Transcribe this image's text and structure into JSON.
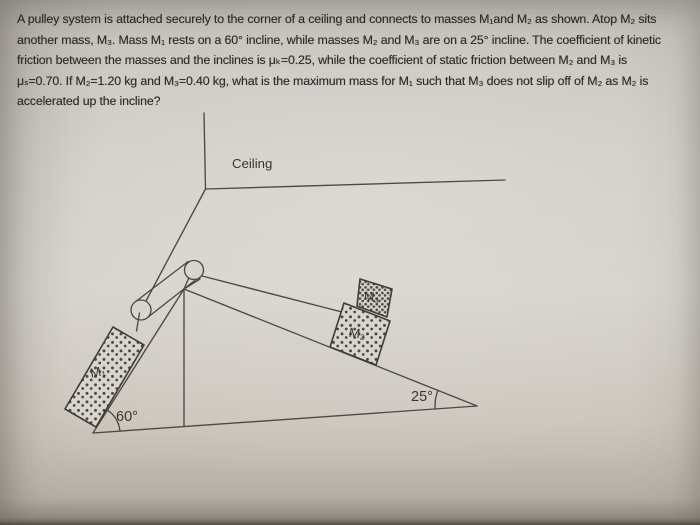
{
  "problem": {
    "lines": [
      "A pulley system is attached securely to the corner of a ceiling and connects to masses M₁and M₂ as shown. Atop M₂ sits",
      "another mass, M₃. Mass M₁ rests on a 60° incline, while masses M₂ and M₃ are on a 25° incline. The coefficient of kinetic",
      "friction between the masses and the inclines is μₖ=0.25, while the coefficient of static friction between M₂ and M₃ is",
      "μₛ=0.70. If M₂=1.20 kg and M₃=0.40 kg, what is the maximum mass for M₁ such that M₃ does not slip off of M₂ as M₂ is",
      "accelerated up the incline?"
    ]
  },
  "diagram": {
    "labels": {
      "ceiling": "Ceiling",
      "m1": "M₁",
      "m2": "M₂",
      "m3": "M₃",
      "angle_left": "60°",
      "angle_right": "25°"
    }
  },
  "colors": {
    "paper": "#d2cec7",
    "ink_lines": "#4d4843",
    "ink_text": "#2d2a26",
    "block_fill": "#d9d5ce",
    "stipple_dot": "#5c564e"
  }
}
